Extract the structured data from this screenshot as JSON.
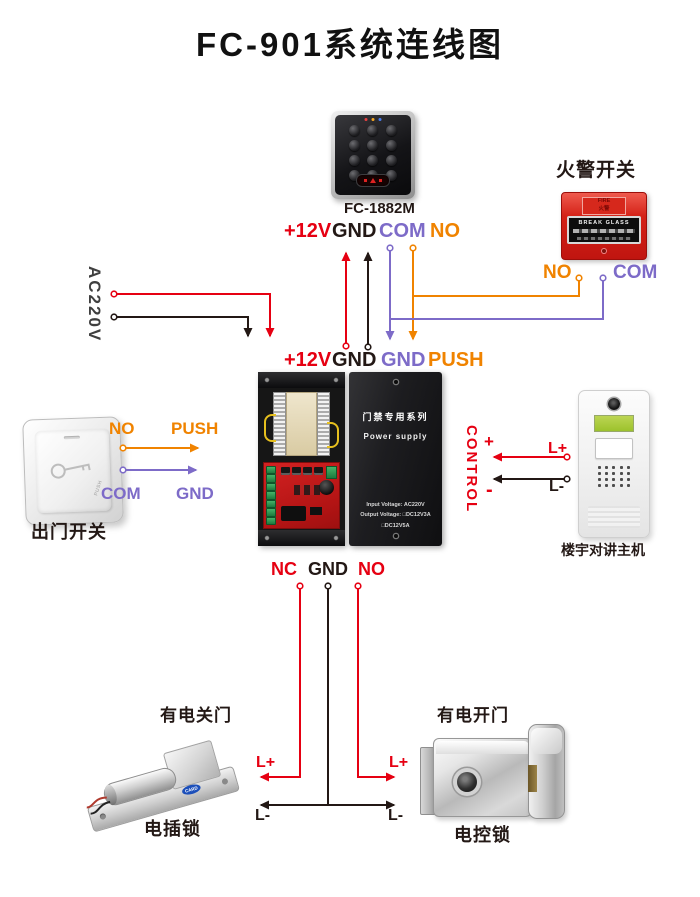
{
  "title": "FC-901系统连线图",
  "colors": {
    "red": "#e60012",
    "black": "#231815",
    "purple": "#7d6bc8",
    "orange": "#f08300"
  },
  "keypad": {
    "model": "FC-1882M"
  },
  "fire_alarm": {
    "title": "火警开关",
    "fire": "FIRE",
    "fire_cn": "火警",
    "glass": "BREAK GLASS",
    "no": "NO",
    "com": "COM"
  },
  "ac_input": {
    "label": "AC220V"
  },
  "keypad_terminals": {
    "v12": "+12V",
    "gnd": "GND",
    "com": "COM",
    "no": "NO"
  },
  "psu_terminals_top": {
    "v12": "+12V",
    "gnd": "GND",
    "gnd2": "GND",
    "push": "PUSH"
  },
  "psu_terminals_bottom": {
    "nc": "NC",
    "gnd": "GND",
    "no": "NO"
  },
  "psu_cover": {
    "series": "门禁专用系列",
    "name": "Power supply",
    "input": "Input Voltage: AC220V",
    "output": "Output Voltage: □DC12V3A □DC12V5A"
  },
  "exit_button": {
    "caption": "出门开关",
    "no": "NO",
    "push": "PUSH",
    "com": "COM",
    "gnd": "GND",
    "engraving": "PUSH"
  },
  "intercom": {
    "caption": "楼宇对讲主机",
    "control": "CONTROL",
    "plus": "+",
    "minus": "-",
    "l_plus": "L+",
    "l_minus": "L-"
  },
  "bolt_lock": {
    "note": "有电关门",
    "caption": "电插锁",
    "l_plus": "L+",
    "l_minus": "L-",
    "logo": "CARD"
  },
  "control_lock": {
    "note": "有电开门",
    "caption": "电控锁",
    "l_plus": "L+",
    "l_minus": "L-"
  }
}
